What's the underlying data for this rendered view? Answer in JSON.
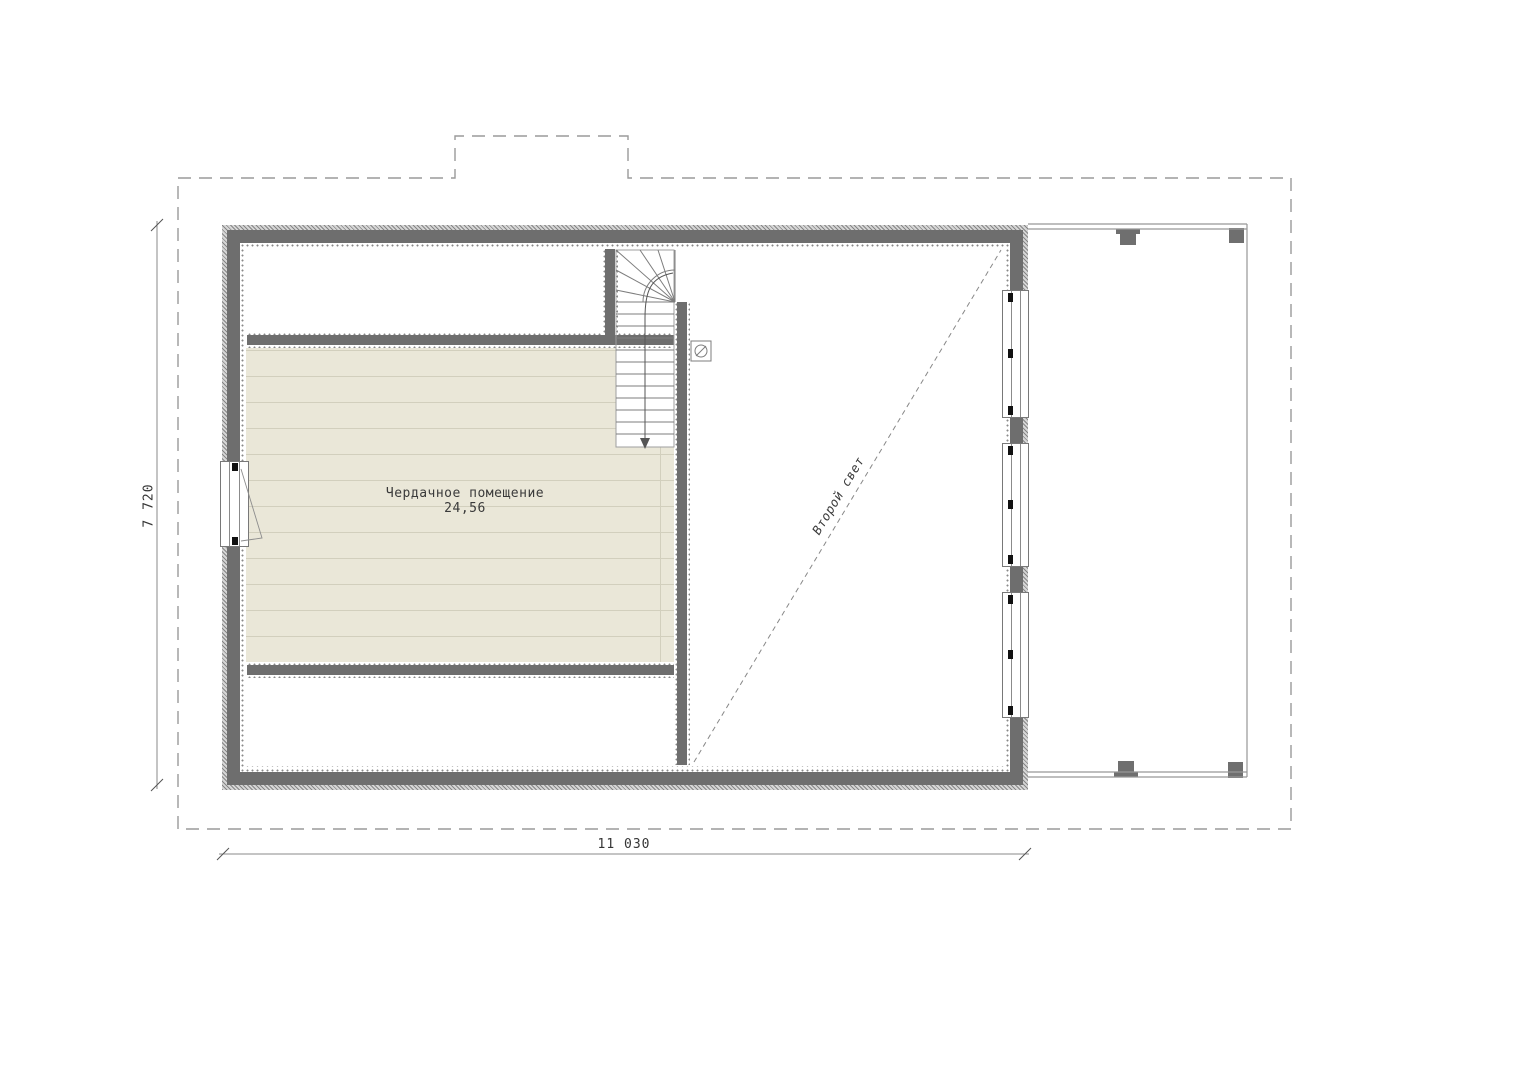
{
  "labels": {
    "room_name": "Чердачное помещение",
    "room_area": "24,56",
    "void": "Второй свет",
    "dim_height": "7 720",
    "dim_width": "11 030"
  },
  "colors": {
    "wall": "#6e6e6e",
    "floor": "#eae7d8",
    "floor-line": "#d2cfbd",
    "line": "#8a8a8a",
    "column": "#6f6f6f",
    "text": "#3a3a3a"
  }
}
